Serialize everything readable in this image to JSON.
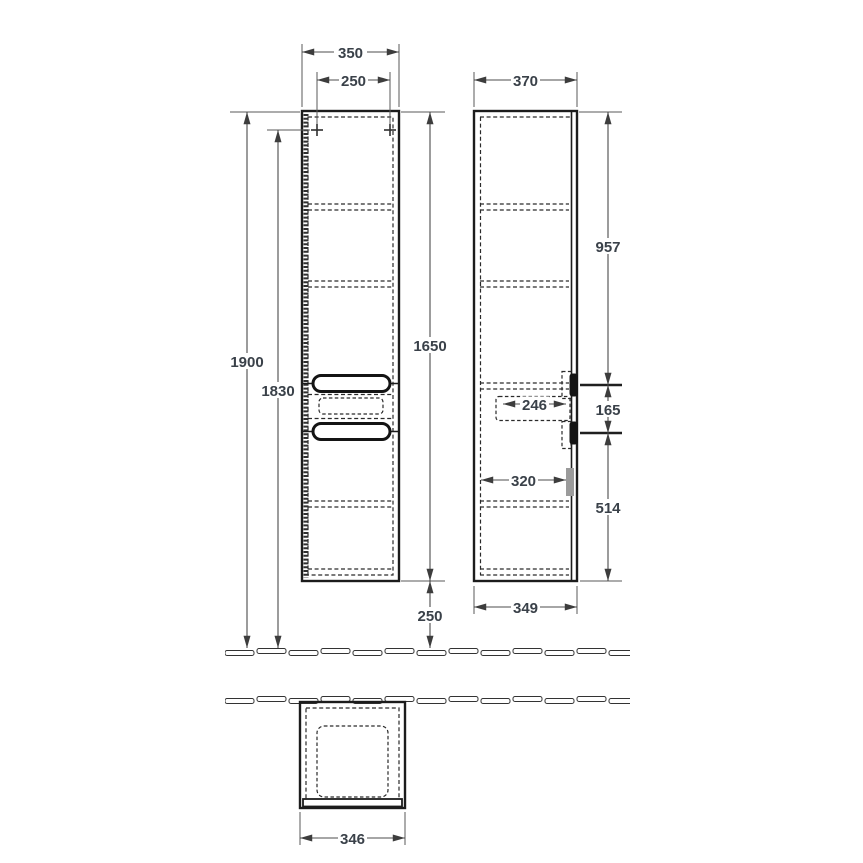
{
  "drawing": {
    "kind": "furniture-dimension-drawing",
    "subject": "tall-side-cabinet",
    "colors": {
      "background": "#ffffff",
      "cabinet_line": "#1c1c1c",
      "dimension_line": "#4c4c4c",
      "dimension_text": "#3a4149",
      "bracket_gray": "#9b9b9b"
    },
    "dimensions": {
      "front_width": "350",
      "mounting_hole_spacing": "250",
      "total_height_to_floor": "1900",
      "mounting_hole_height": "1830",
      "cabinet_height": "1650",
      "floor_clearance": "250",
      "side_depth": "370",
      "top_to_upper_handle": "957",
      "handle_spacing": "165",
      "lower_handle_to_bottom": "514",
      "drawer_inner_depth": "246",
      "inner_depth": "320",
      "bottom_depth": "349",
      "top_view_width": "346"
    }
  }
}
